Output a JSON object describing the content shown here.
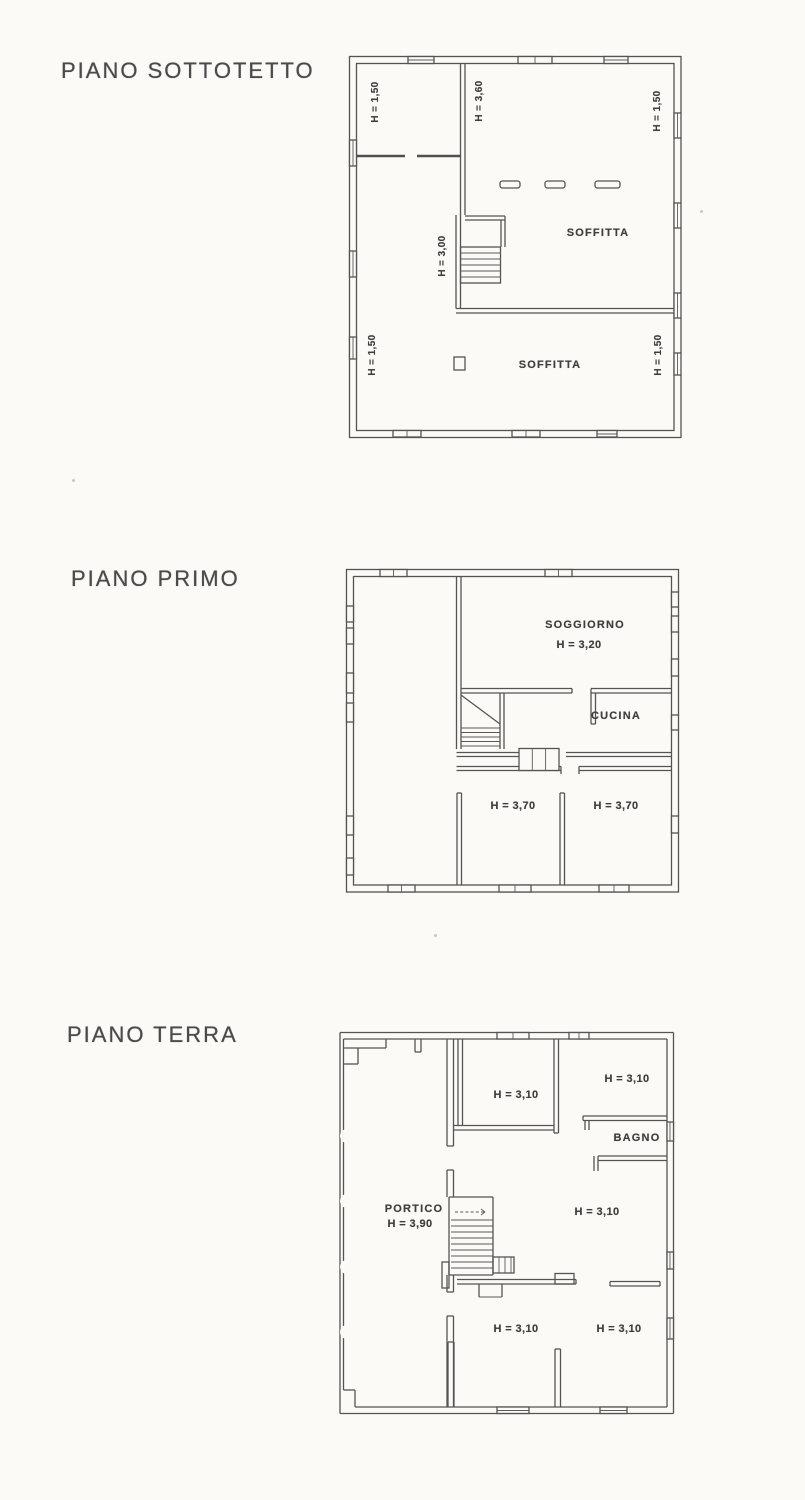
{
  "document": {
    "background": "#fbfaf7",
    "ink": "#4f4f4f"
  },
  "floors": {
    "sottotetto": {
      "title": "PIANO SOTTOTETTO",
      "labels": {
        "left_upper_height": "H = 1,50",
        "ridge_height": "H = 3,60",
        "right_upper_height": "H = 1,50",
        "stair_height": "H = 3,00",
        "soffitta_upper": "SOFFITTA",
        "left_lower_height": "H = 1,50",
        "right_lower_height": "H = 1,50",
        "soffitta_lower": "SOFFITTA"
      }
    },
    "primo": {
      "title": "PIANO PRIMO",
      "labels": {
        "soggiorno": "SOGGIORNO",
        "soggiorno_height": "H = 3,20",
        "cucina": "CUCINA",
        "camera_left_height": "H = 3,70",
        "camera_right_height": "H = 3,70"
      }
    },
    "terra": {
      "title": "PIANO TERRA",
      "labels": {
        "room_top_center_height": "H = 3,10",
        "room_top_right_height": "H = 3,10",
        "bagno": "BAGNO",
        "portico": "PORTICO",
        "portico_height": "H = 3,90",
        "room_mid_right_height": "H = 3,10",
        "room_bottom_left_height": "H = 3,10",
        "room_bottom_right_height": "H = 3,10"
      }
    }
  }
}
